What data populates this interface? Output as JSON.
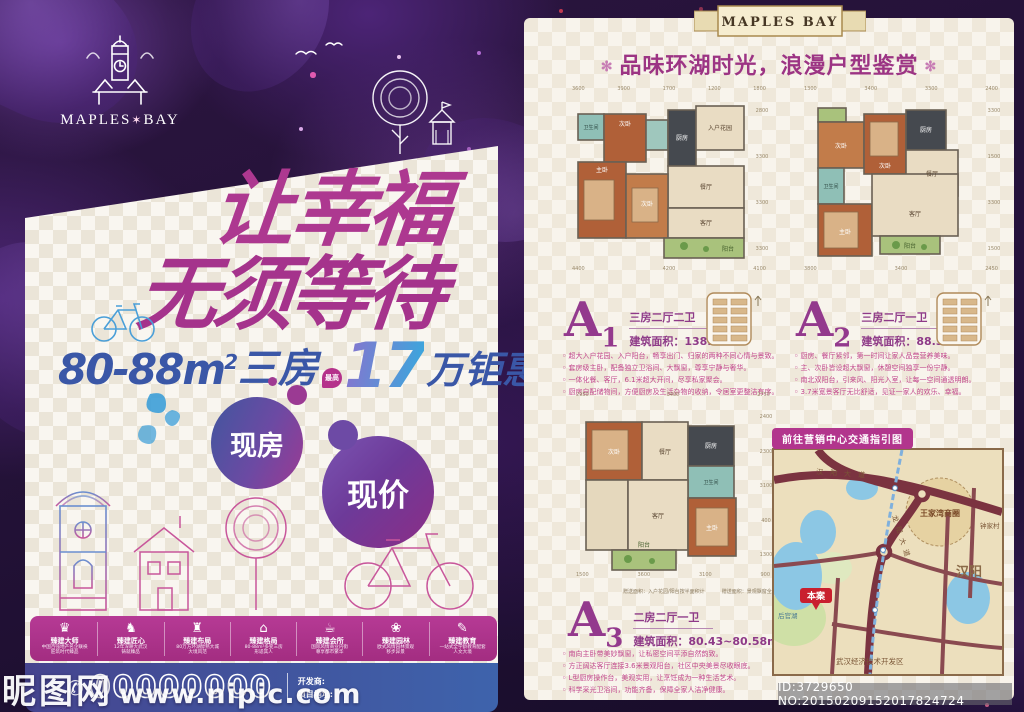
{
  "left": {
    "logo": {
      "left": "MAPLES",
      "star": "✶",
      "right": "BAY"
    },
    "headline": {
      "line1": "让幸福",
      "line2": "无须等待"
    },
    "offer": {
      "range": "80-88m",
      "sup": "2",
      "rooms": "三房",
      "badge": "最高",
      "big_number": "17",
      "suffix": "万钜惠"
    },
    "bubbles": {
      "b1": "现房",
      "b2": "现价"
    },
    "features": [
      {
        "glyph": "♛",
        "title": "臻建大师",
        "desc1": "中国百强地产名企联袂",
        "desc2": "匠筑时代臻品"
      },
      {
        "glyph": "♞",
        "title": "臻建匠心",
        "desc1": "12年深耕大武汉",
        "desc2": "铸就臻品"
      },
      {
        "glyph": "♜",
        "title": "臻建布局",
        "desc1": "80万方环湖醇熟大城",
        "desc2": "大境风范"
      },
      {
        "glyph": "⌂",
        "title": "臻建格局",
        "desc1": "80-88m²多变三房",
        "desc2": "形适其人"
      },
      {
        "glyph": "☕",
        "title": "臻建会所",
        "desc1": "国际风情商业内街",
        "desc2": "尊享都市繁华"
      },
      {
        "glyph": "❀",
        "title": "臻建园林",
        "desc1": "欧式风情园林景观",
        "desc2": "移步异景"
      },
      {
        "glyph": "✎",
        "title": "臻建教育",
        "desc1": "一站式全学龄教育配套",
        "desc2": "人文大境"
      }
    ],
    "contact": {
      "phone_icon": "✆",
      "phone": "00000000",
      "developer_label": "开发商:",
      "address_label": "项目地址:"
    }
  },
  "right": {
    "ribbon": "MAPLES BAY",
    "title_deco": "✻",
    "title": "品味环湖时光，浪漫户型鉴赏",
    "units": [
      {
        "code": "A",
        "num": "1",
        "type": "三房二厅二卫",
        "area_label": "建筑面积：",
        "area": "138.86m²",
        "bullets": [
          "超大入户花园、入户阳台，畅享出门、归家的两种不同心情与景致。",
          "套房级主卧，配备独立卫浴间、大飘窗，尊享宁静与奢华。",
          "一体化餐、客厅，6.1米超大开间，尽享私家聚会。",
          "厨房自配储物间，方便厨房及生活杂物的收纳，令居室更整洁有序。"
        ],
        "plan": {
          "dims_top": "3600 3900 1700 1200 1800",
          "dims_side": "2800 3300 3300 3300",
          "dims_bottom": "4400 4200 4100",
          "rooms": {
            "garden": "入户花园",
            "kitchen": "厨房",
            "dining": "餐厅",
            "living": "客厅",
            "balcony": "阳台",
            "master": "主卧",
            "bed2": "次卧",
            "bed3": "次卧",
            "bath1": "卫生间"
          }
        }
      },
      {
        "code": "A",
        "num": "2",
        "type": "三房二厅一卫",
        "area_label": "建筑面积：",
        "area": "88.33m²",
        "bullets": [
          "厨房、餐厅紧邻，第一时间让家人品尝营养美味。",
          "主、次卧皆设超大飘窗，休憩空间独享一份宁静。",
          "南北双阳台，引来风、阳光入室，让每一空间通透明朗。",
          "3.7米宽景客厅无比舒适，见证一家人的欢乐、幸福。"
        ],
        "plan": {
          "dims_top": "1300 3400 3300 2400",
          "dims_side": "3300 1500 3300 1500",
          "dims_bottom": "3800 3400 2450",
          "rooms": {
            "bed2": "次卧",
            "bed3": "次卧",
            "kitchen": "厨房",
            "dining": "餐厅",
            "bath": "卫生间",
            "master": "主卧",
            "living": "客厅",
            "balcony": "阳台"
          }
        }
      },
      {
        "code": "A",
        "num": "3",
        "type": "二房二厅一卫",
        "area_label": "建筑面积：",
        "area": "80.43~80.58m²",
        "bullets": [
          "南向主卧带美妙飘窗，让私密空间平添自然韵致。",
          "方正阔达客厅连接3.6米景观阳台，社区中央美景尽收眼底。",
          "L型厨房操作台，美观实用，让烹饪成为一种生活艺术。",
          "科学采光卫浴间，功能齐备，保障全家人洁净健康。"
        ],
        "plan": {
          "dims_top": "2950 3400 2750",
          "dims_side": "2400 2300 3100 400 1300",
          "dims_bottom": "1500 3600 3100 900",
          "rooms": {
            "bed2": "次卧",
            "dining": "餐厅",
            "kitchen": "厨房",
            "bath": "卫生间",
            "living": "客厅",
            "master": "主卧",
            "balcony": "阳台"
          }
        }
      }
    ],
    "legend": [
      {
        "color": "#e08a5a",
        "label": "赠送面积：入户花园/阳台按半面积计"
      },
      {
        "color": "#b9cf8e",
        "label": "赠送面积：景观飘窗全面积赠送"
      }
    ],
    "map": {
      "title": "前往营销中心交通指引图",
      "labels": {
        "road_top": "汉阳大道",
        "road_diag": "龙阳大道",
        "cbd": "王家湾商圈",
        "zjc": "钟家村",
        "hanyang": "汉阳",
        "site": "本案",
        "lake": "后官湖",
        "dev": "武汉经济技术开发区"
      }
    }
  },
  "watermark": {
    "site": "昵图网",
    "url": "www.nipic.com",
    "idline": "ID:3729650 NO:20150209152017824724"
  }
}
